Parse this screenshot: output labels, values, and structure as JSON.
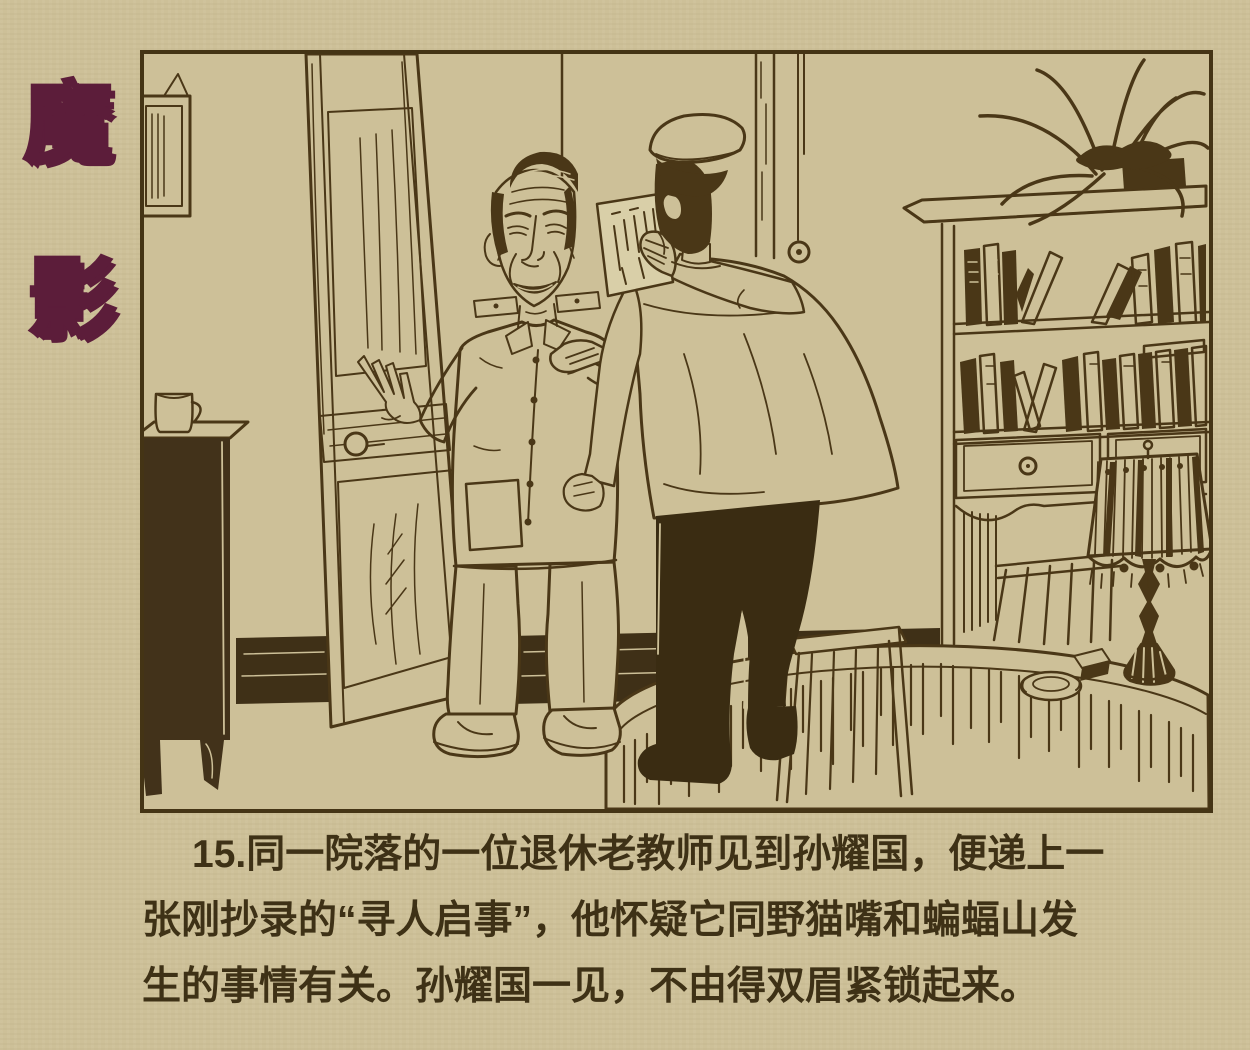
{
  "page": {
    "background_color": "#cdc098",
    "ink_color": "#463617"
  },
  "title": {
    "text": "魔影",
    "chars": [
      "魔",
      "影"
    ],
    "color": "#5c1d3a"
  },
  "panel": {
    "number": "15",
    "border_color": "#443415"
  },
  "caption": {
    "text_color": "#3e3116",
    "lines": [
      "15.同一院落的一位退休老教师见到孙耀国，便递上一",
      "张刚抄录的“寻人启事”，他怀疑它同野猫嘴和蝙蝠山发",
      "生的事情有关。孙耀国一见，不由得双眉紧锁起来。"
    ],
    "full_text": "15.同一院落的一位退休老教师见到孙耀国，便递上一张刚抄录的“寻人启事”，他怀疑它同野猫嘴和蝙蝠山发生的事情有关。孙耀国一见，不由得双眉紧锁起来。"
  },
  "illustration": {
    "scene_elements": [
      "open-wooden-door",
      "retired-teacher-figure",
      "visitor-back-view-figure",
      "peaked-cap",
      "notice-paper",
      "bookshelf-with-books",
      "spider-plant",
      "fringed-table-lamp",
      "round-table",
      "ashtray",
      "cigarette-pack",
      "wooden-chair",
      "side-cabinet",
      "tea-mug",
      "picture-frame",
      "hanging-pull-cord",
      "baseboard"
    ]
  }
}
